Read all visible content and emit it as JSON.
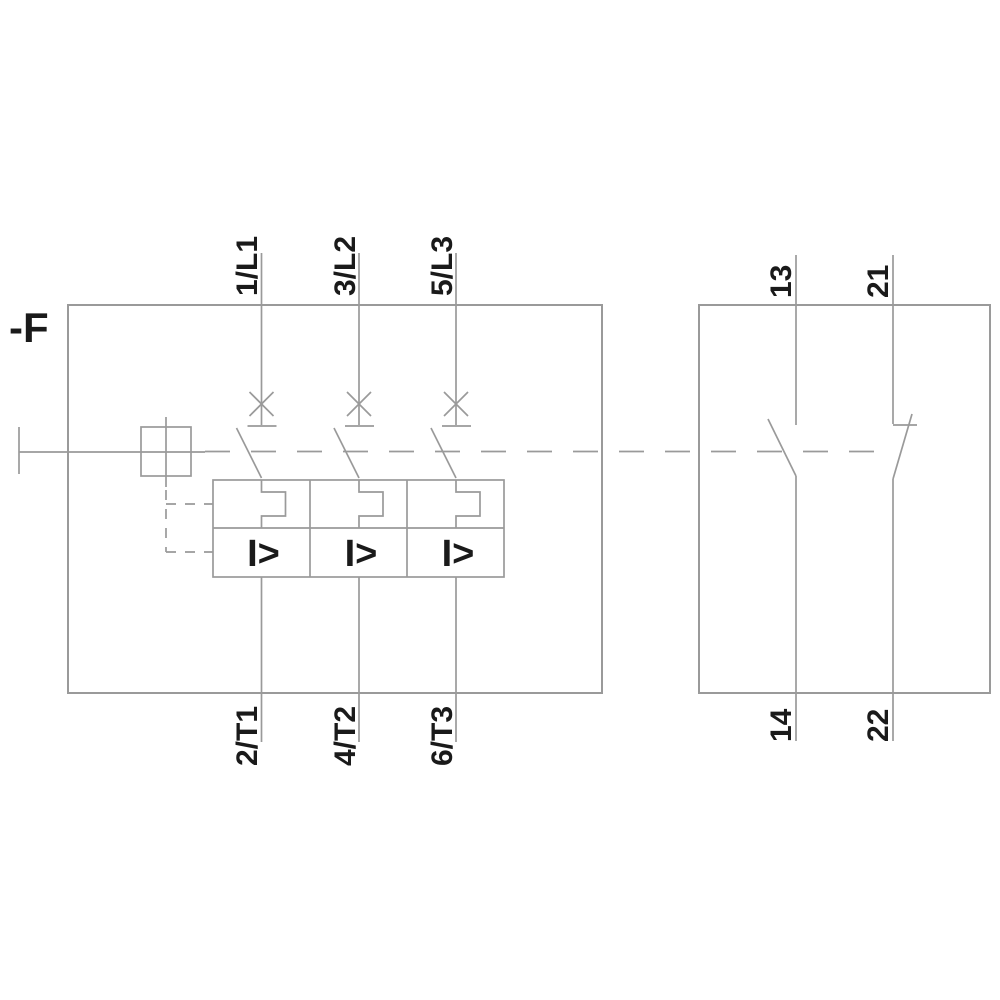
{
  "device": {
    "tag": "-F"
  },
  "colors": {
    "line": "#9a9a9a",
    "text": "#1a1a1a",
    "background": "#ffffff"
  },
  "main_poles": {
    "top_terminals": [
      "1/L1",
      "3/L2",
      "5/L3"
    ],
    "bottom_terminals": [
      "2/T1",
      "4/T2",
      "6/T3"
    ],
    "magnetic_trip_symbol": "I>"
  },
  "aux_contacts": {
    "top_terminals": [
      "13",
      "21"
    ],
    "bottom_terminals": [
      "14",
      "22"
    ]
  }
}
